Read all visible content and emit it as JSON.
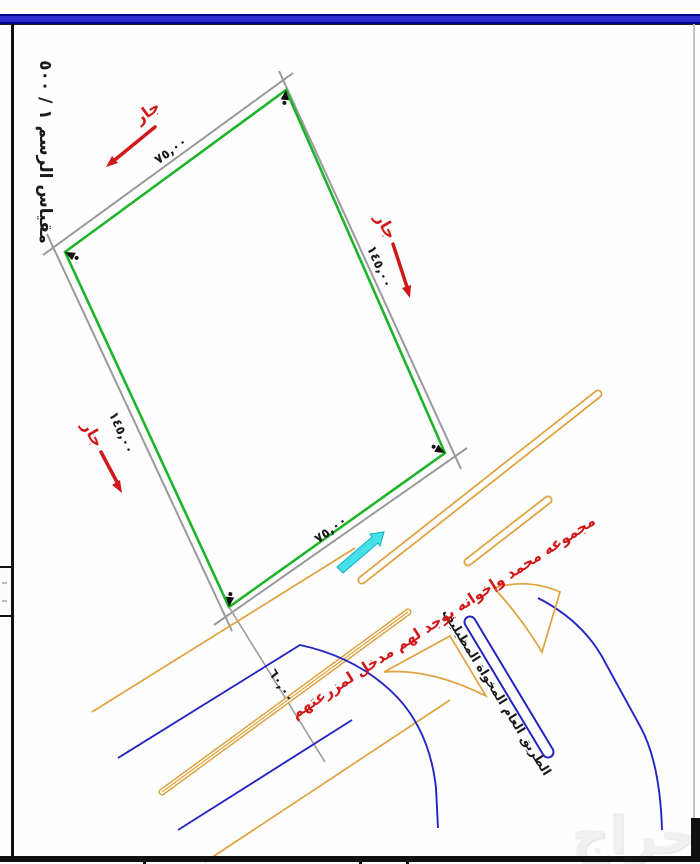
{
  "watermark_text": "حراج",
  "scale_label": "مقياس الرسم ١ / ٥٠٠",
  "plot": {
    "dim_top": "٧٥,٠٠",
    "dim_bottom": "٧٥,٠٠",
    "dim_left": "١٤٥,٠٠",
    "dim_right": "١٤٥,٠٠",
    "neighbor_label": "جار"
  },
  "road": {
    "width_label": "٦٠,٠٠",
    "name_label": "الطريق العام المخواة المظيليف",
    "red_note": "مجموعه محمد وإخوانه يوجد لهم مدخل لمزرعتهم"
  },
  "icons": {
    "corner_marker": "corner-marker-arrow",
    "neighbor_arrow": "red-neighbor-arrow",
    "entrance_arrow": "cyan-entrance-arrow"
  },
  "colors": {
    "plot_green": "#1db42b",
    "boundary_gray": "#9a9a9a",
    "road_orange": "#dfa23e",
    "road_blue": "#2525c4",
    "annotation_red": "#d01818",
    "entrance_cyan": "#45e0e8",
    "band_blue": "#2b2bd0",
    "band_navy": "#00008b"
  }
}
